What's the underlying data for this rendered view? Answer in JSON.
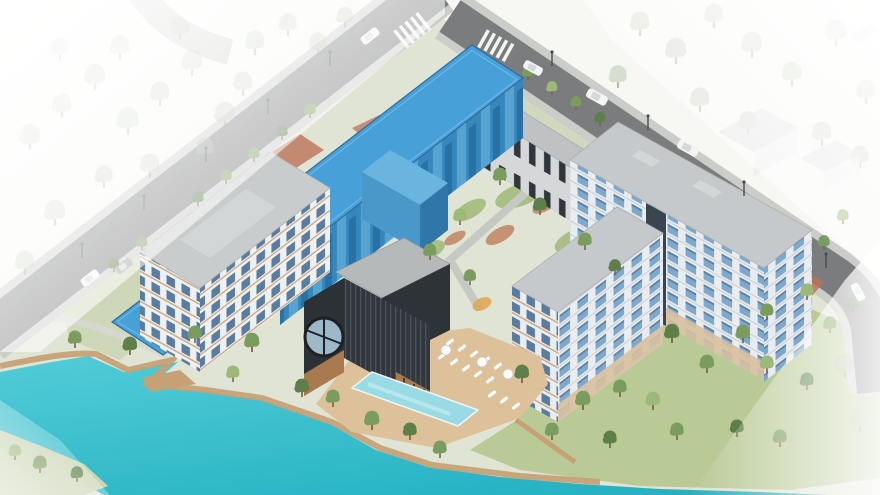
{
  "scene": {
    "type": "architectural-aerial-site-rendering",
    "highlighted_building_selected": true,
    "objects": [
      "perimeter-streets",
      "highlighted-residential-block",
      "courtyard-rowhouse",
      "main-residential-building",
      "l-shaped-residential-building",
      "clubhouse-with-round-window",
      "outdoor-pool",
      "pool-deck-loungers",
      "central-courtyard-playground",
      "lakefront-boardwalk",
      "lake",
      "park-trees",
      "street-cars",
      "street-lamps",
      "crosswalks"
    ]
  },
  "colors": {
    "ground": "#e0e4d5",
    "lawn": "#a9bf83",
    "lawn_slope": "#b9ca96",
    "lawn_pale": "#ccd6b6",
    "path": "#c6c9c2",
    "planting": "#c08463",
    "playground": "#e2a44f",
    "asphalt": "#7a7c7e",
    "sidewalk": "#cbcdc9",
    "crosswalk": "#f3f4f2",
    "brick_crossing": "#bd7258",
    "water": "#35bfcc",
    "boardwalk": "#c6a176",
    "deck": "#dcc19b",
    "pool": "#98dbe5",
    "highlight_roof": "#47a1d8",
    "highlight_facade": "#3787bd",
    "highlight_annex": "#69b5e0",
    "highlight_edge": "#2a6da0",
    "white_wall": "#eaedef",
    "window_blue": "#7ea9cd",
    "roof_gray": "#c6c9cb",
    "stairwell_dark": "#3a464f",
    "base_tan": "#d8c0a0",
    "rowhouse_wall": "#d6d7d8",
    "rowhouse_roof": "#bfc1c2",
    "l_wall": "#eef0f2",
    "l_roof": "#c9cccd",
    "club_dark": "#2c3136",
    "club_roof": "#23282d",
    "club_back_roof": "#b6b9ba",
    "club_wood": "#a87a4d",
    "tree_mid": "#7a9c5e",
    "tree_dark": "#5e7f49",
    "tree_light": "#9cb979",
    "tree_faded": "#a9bb9a",
    "car_white": "#f4f5f3",
    "car_gray": "#9fa3a6",
    "lamp": "#4a4d4f",
    "lounger": "#ffffff"
  }
}
